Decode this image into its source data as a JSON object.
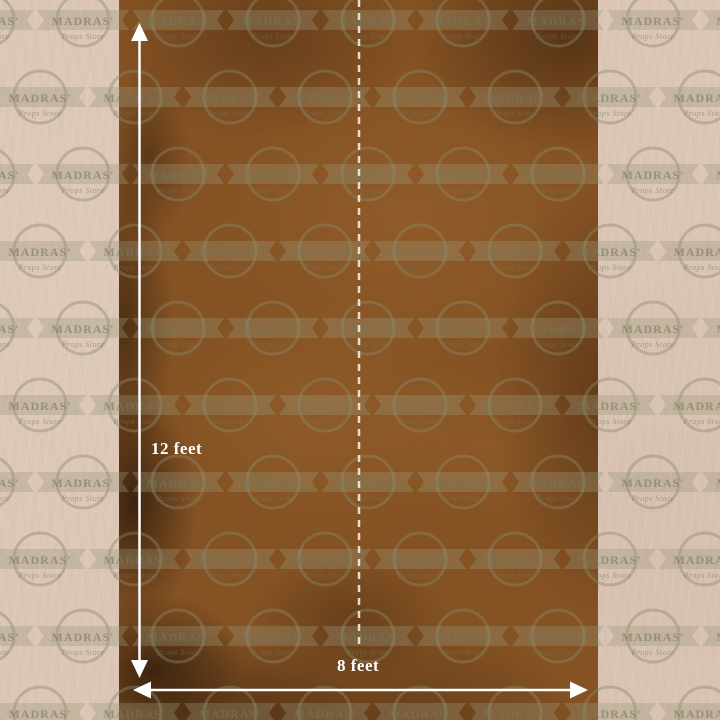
{
  "product": {
    "description": "Brown textured photography backdrop with size markings"
  },
  "dimensions": {
    "height_label": "12 feet",
    "width_label": "8 feet"
  },
  "watermark": {
    "brand": "MADRAS'",
    "subtitle": "Props Store"
  },
  "colors": {
    "background": "#dbc5b5",
    "backdrop_base": "#845223",
    "backdrop_shadow": "#3a1e0a",
    "annotation": "#ffffff",
    "watermark_tint": "#8b8a6e"
  }
}
